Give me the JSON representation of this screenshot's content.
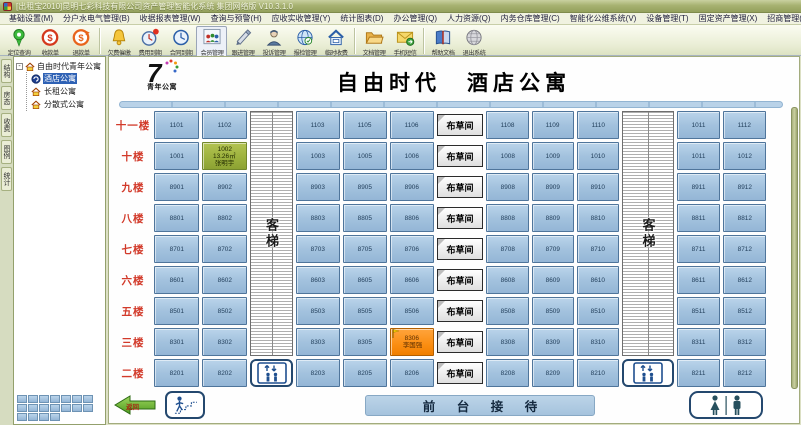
{
  "window": {
    "title": "[出租宝2010]昆明七彩科技有限公司资产管理智能化系统 集团网络版 V10.3.1.0"
  },
  "menu_bar": {
    "items": [
      {
        "label": "基础设置(M)"
      },
      {
        "label": "分户水电气管理(B)"
      },
      {
        "label": "收据报表管理(W)"
      },
      {
        "label": "查询与预警(H)"
      },
      {
        "label": "应收实收管理(Y)"
      },
      {
        "label": "统计图表(D)"
      },
      {
        "label": "办公管理(Q)"
      },
      {
        "label": "人力资源(Q)"
      },
      {
        "label": "内务仓库管理(C)"
      },
      {
        "label": "智能化公维系统(V)"
      },
      {
        "label": "设备管理(T)"
      },
      {
        "label": "固定资产管理(X)"
      },
      {
        "label": "招商管理(L)"
      },
      {
        "label": "系统管理(S)"
      },
      {
        "label": "帮助(H)"
      }
    ]
  },
  "toolbar": {
    "items": [
      {
        "label": "定位查询",
        "icon": "location-pin-icon"
      },
      {
        "label": "收款单",
        "icon": "receipt-money-icon"
      },
      {
        "label": "退款单",
        "icon": "refund-money-icon"
      },
      {
        "label": "欠费催缴",
        "icon": "bell-icon",
        "sep_before": true
      },
      {
        "label": "费用到期",
        "icon": "clock-alert-icon"
      },
      {
        "label": "合同到期",
        "icon": "clock-blue-icon"
      },
      {
        "label": "会员管理",
        "icon": "members-icon",
        "active": true
      },
      {
        "label": "跟进管理",
        "icon": "pen-hand-icon"
      },
      {
        "label": "投诉管理",
        "icon": "complaint-person-icon"
      },
      {
        "label": "报检管理",
        "icon": "globe-check-icon"
      },
      {
        "label": "临时收费",
        "icon": "house-fee-icon"
      },
      {
        "label": "文档管理",
        "icon": "folder-icon",
        "sep_before": true
      },
      {
        "label": "手机短信",
        "icon": "sms-envelope-icon"
      },
      {
        "label": "帮助文档",
        "icon": "help-book-icon",
        "sep_before": true
      },
      {
        "label": "退出系统",
        "icon": "exit-globe-icon"
      }
    ]
  },
  "sidebar": {
    "tabs": [
      {
        "label": "结构"
      },
      {
        "label": "房态"
      },
      {
        "label": "收费"
      },
      {
        "label": "图例"
      },
      {
        "label": "统计"
      }
    ],
    "tree": {
      "expander": "-",
      "root": {
        "label": "自由时代青年公寓",
        "icon": "home-icon"
      },
      "items": [
        {
          "label": "酒店公寓",
          "icon": "hotel-logo-icon",
          "selected": true
        },
        {
          "label": "长租公寓",
          "icon": "home-icon",
          "selected": false
        },
        {
          "label": "分散式公寓",
          "icon": "home-icon",
          "selected": false
        }
      ]
    },
    "mini_map": {
      "rows": [
        7,
        7,
        4
      ]
    }
  },
  "main": {
    "logo": {
      "number": "7",
      "brand": "青年公寓"
    },
    "title": "自由时代　酒店公寓",
    "shaft_label": "客梯",
    "linen_label": "布草间",
    "floors": [
      {
        "label": "十一楼",
        "rooms": [
          "1101",
          "1102",
          "1103",
          "1105",
          "1106",
          "1108",
          "1109",
          "1110",
          "1011",
          "1112"
        ]
      },
      {
        "label": "十楼",
        "rooms": [
          "1001",
          {
            "num": "1002",
            "area": "13.26㎡",
            "name": "张明宇",
            "status": "green"
          },
          "1003",
          "1005",
          "1006",
          "1008",
          "1009",
          "1010",
          "1011",
          "1012"
        ]
      },
      {
        "label": "九楼",
        "rooms": [
          "8901",
          "8902",
          "8903",
          "8905",
          "8906",
          "8908",
          "8909",
          "8910",
          "8911",
          "8912"
        ]
      },
      {
        "label": "八楼",
        "rooms": [
          "8801",
          "8802",
          "8803",
          "8805",
          "8806",
          "8808",
          "8809",
          "8810",
          "8811",
          "8812"
        ]
      },
      {
        "label": "七楼",
        "rooms": [
          "8701",
          "8702",
          "8703",
          "8705",
          "8706",
          "8708",
          "8709",
          "8710",
          "8711",
          "8712"
        ]
      },
      {
        "label": "六楼",
        "rooms": [
          "8601",
          "8602",
          "8603",
          "8605",
          "8606",
          "8608",
          "8609",
          "8610",
          "8611",
          "8612"
        ]
      },
      {
        "label": "五楼",
        "rooms": [
          "8501",
          "8502",
          "8503",
          "8505",
          "8506",
          "8508",
          "8509",
          "8510",
          "8511",
          "8512"
        ]
      },
      {
        "label": "三楼",
        "rooms": [
          "8301",
          "8302",
          "8303",
          "8305",
          {
            "num": "8306",
            "name": "李国强",
            "status": "orange",
            "flag": true
          },
          "8308",
          "8309",
          "8310",
          "8311",
          "8312"
        ]
      },
      {
        "label": "二楼",
        "rooms": [
          "8201",
          "8202",
          "8203",
          "8205",
          "8206",
          "8208",
          "8209",
          "8210",
          "8211",
          "8212"
        ]
      }
    ],
    "footer": {
      "back_label": "返回",
      "front_desk": "前 台 接 待"
    }
  },
  "colors": {
    "room_blue": "#A3C2DE",
    "occupied_green": "#9DB23E",
    "occupied_orange": "#FB8E12",
    "floor_label_red": "#D23A2A",
    "front_desk_bar": "#AFCBE3",
    "titlebar_olive": "#A7B271",
    "selection_blue": "#2F62B5"
  }
}
